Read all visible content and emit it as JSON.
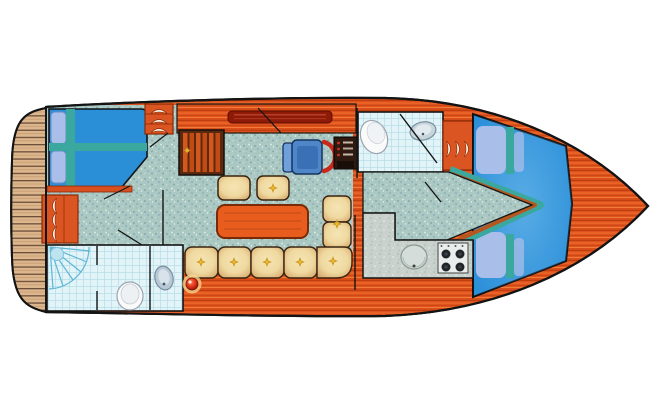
{
  "plan": {
    "kind": "yacht-deck-floor-plan",
    "features": [
      {
        "id": "swim-platform",
        "depicts": "teak swim platform at stern"
      },
      {
        "id": "aft-cabin",
        "depicts": "twin berths with teal runner cross"
      },
      {
        "id": "aft-head",
        "depicts": "shower, toilet and washbasin"
      },
      {
        "id": "wardrobe-lockers",
        "depicts": "louvered locker doors"
      },
      {
        "id": "companionway-stairs",
        "depicts": "steps down to salon"
      },
      {
        "id": "salon",
        "depicts": "dinette table, two stools, L-shaped settee"
      },
      {
        "id": "helm",
        "depicts": "helm seat, steering wheel, instrument panel"
      },
      {
        "id": "galley",
        "depicts": "counter with sink and 4-burner stove"
      },
      {
        "id": "forward-head",
        "depicts": "toilet and washbasin"
      },
      {
        "id": "bow-cabin",
        "depicts": "island double berth with pillows"
      }
    ],
    "counts": {
      "settee_cushions": 7,
      "stools": 2,
      "berths_aft": 2,
      "stove_burners": 4
    }
  },
  "palette": {
    "hull_wood": "#E25420",
    "wood_streak_dark": "#B93A0C",
    "wood_streak_light": "#F0722E",
    "platform_teak": "#DCB68C",
    "carpet": "#ABC8C3",
    "tile": "#E2F4F8",
    "bed_blue": "#2B8FD8",
    "trim_teal": "#3BA8A0",
    "pillow_blue": "#A9BEE8",
    "sofa_cream": "#F5E4B4",
    "tuft_gold": "#C8941A",
    "table_orange": "#E85C1E",
    "locker_orange": "#DB5522",
    "counter_gray": "#C9D1CD",
    "chair_blue": "#4E86C8",
    "wheel_red": "#C8281A",
    "panel_brown": "#2E1A10",
    "pentagon_border": "#B5571E",
    "outline": "#141414",
    "fixture_white": "#FAFAFA",
    "shower_blue": "#5FB6D6"
  }
}
